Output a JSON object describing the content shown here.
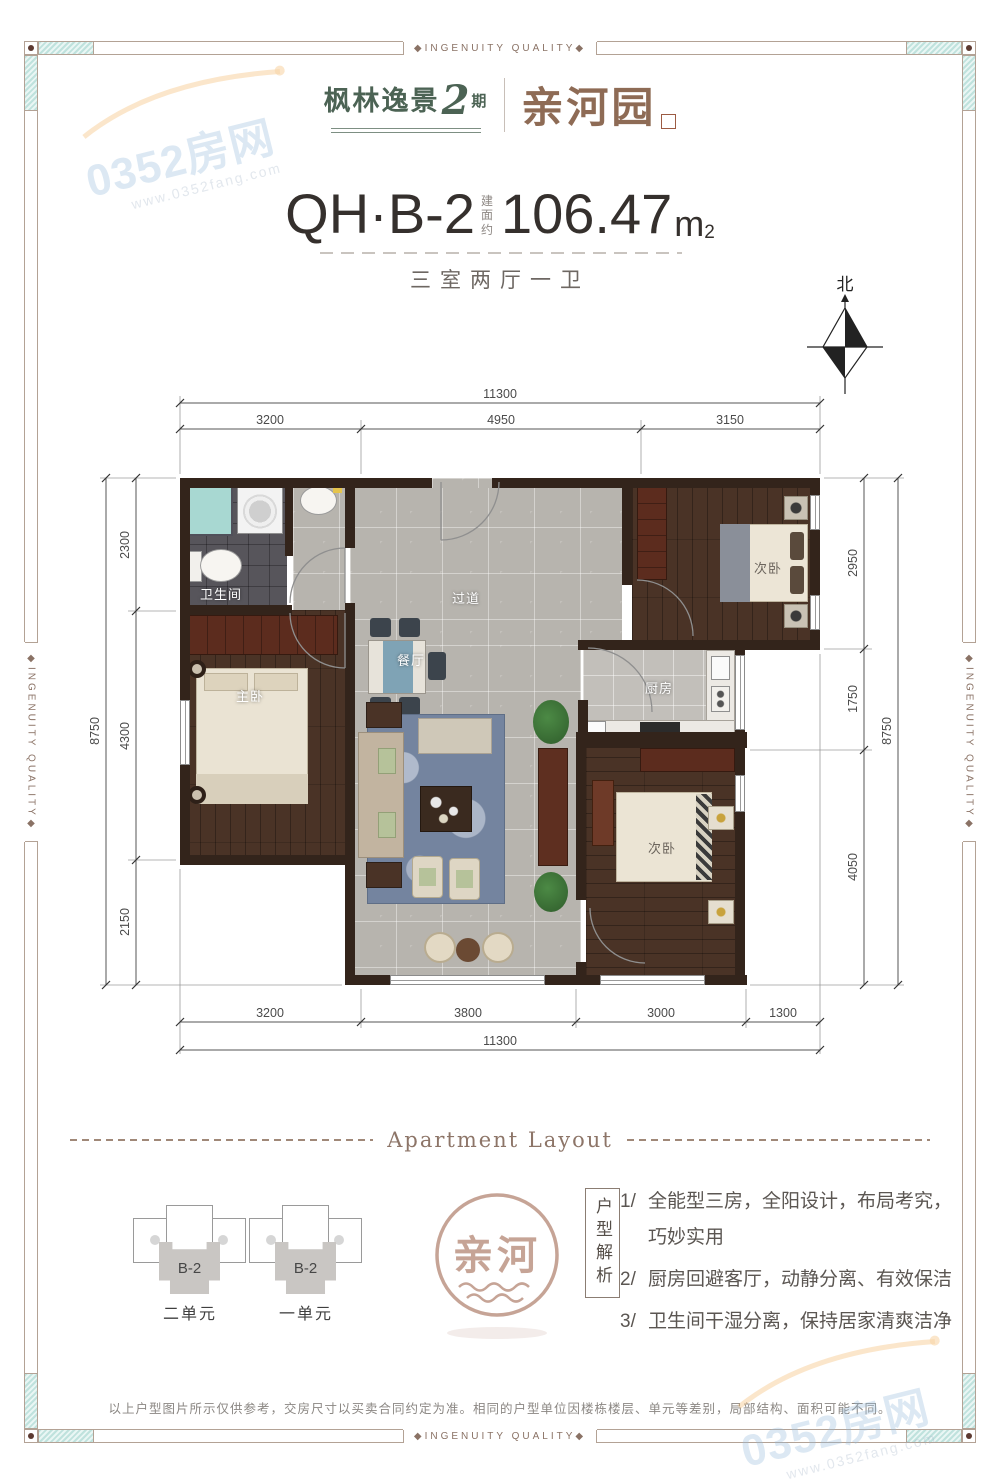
{
  "frame": {
    "banner_top": "◆INGENUITY QUALITY◆",
    "banner_bottom": "◆INGENUITY QUALITY◆",
    "banner_left": "◆INGENUITY QUALITY◆",
    "banner_right": "◆INGENUITY QUALITY◆"
  },
  "watermark": {
    "site": "0352房网",
    "url": "www.0352fang.com"
  },
  "brand": {
    "name": "枫林逸景",
    "phase_num": "2",
    "phase_word": "期",
    "sub_name": "亲河园"
  },
  "title": {
    "unit_code": "QH·B-2",
    "area_label": "建面约",
    "area_value": "106.47",
    "area_unit_m": "m",
    "area_unit_exp": "2",
    "layout_desc": "三室两厅一卫"
  },
  "compass": {
    "north": "北"
  },
  "plan": {
    "rooms": {
      "bathroom": "卫生间",
      "hallway": "过道",
      "dining": "餐厅",
      "kitchen": "厨房",
      "master_bedroom": "主卧",
      "bedroom_top": "次卧",
      "bedroom_bottom": "次卧"
    },
    "dimensions": {
      "top_total": "11300",
      "top_segments": [
        "3200",
        "4950",
        "3150"
      ],
      "left_total": "8750",
      "left_segments": [
        "2300",
        "4300",
        "2150"
      ],
      "right_total": "8750",
      "right_segments": [
        "2950",
        "1750",
        "4050"
      ],
      "bottom_total": "11300",
      "bottom_segments": [
        "3200",
        "3800",
        "3000",
        "1300"
      ]
    }
  },
  "section_divider": {
    "label": "Apartment Layout"
  },
  "units": {
    "items": [
      {
        "unit_label": "B-2",
        "name": "二单元"
      },
      {
        "unit_label": "B-2",
        "name": "一单元"
      }
    ]
  },
  "seal": {
    "text": "亲河"
  },
  "analysis": {
    "heading": "户型解析",
    "items": [
      {
        "num": "1/",
        "lines": [
          "全能型三房，全阳设计，布局考究，",
          "巧妙实用"
        ]
      },
      {
        "num": "2/",
        "lines": [
          "厨房回避客厅，动静分离、有效保洁"
        ]
      },
      {
        "num": "3/",
        "lines": [
          "卫生间干湿分离，保持居家清爽洁净"
        ]
      }
    ]
  },
  "footer": {
    "disclaimer": "以上户型图片所示仅供参考，交房尺寸以买卖合同约定为准。相同的户型单位因楼栋楼层、单元等差别，局部结构、面积可能不同。"
  }
}
